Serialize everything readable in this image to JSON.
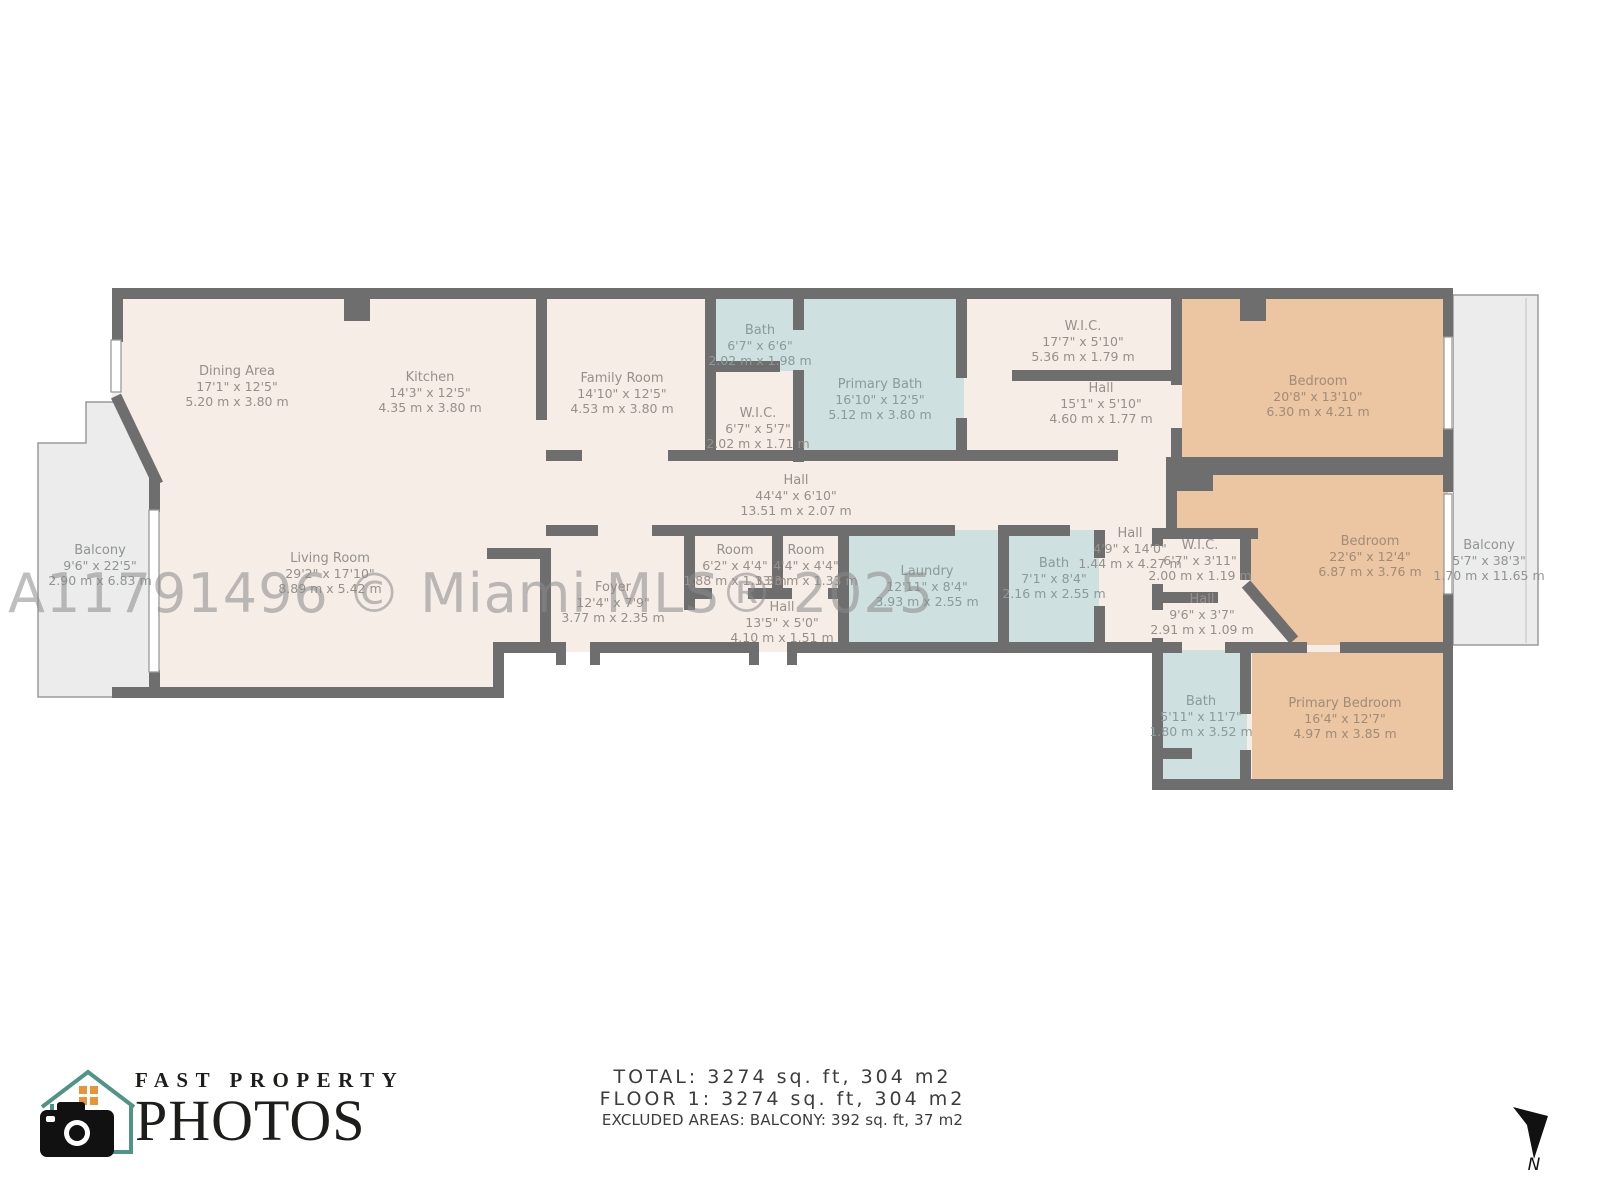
{
  "watermark": "A11791496 © Miami MLS® 2025",
  "footer": {
    "line1": "TOTAL: 3274 sq. ft, 304 m2",
    "line2": "FLOOR 1: 3274 sq. ft, 304 m2",
    "line3": "EXCLUDED AREAS: BALCONY: 392 sq. ft, 37 m2"
  },
  "logo": {
    "top": "FAST PROPERTY",
    "bottom": "PHOTOS"
  },
  "compass": {
    "label": "N"
  },
  "colors": {
    "wall": "#6e6e6e",
    "floor": "#f6ede7",
    "wet": "#cfe0e0",
    "bedroom": "#ecc5a2",
    "balcony": "#ececec",
    "outline": "#9a9a9a",
    "labelFloor": "#96908a",
    "labelWet": "#8a9b9b",
    "labelBedroom": "#a18c77",
    "labelBalcony": "#8f9494",
    "watermarkColor": "#8a8a8a",
    "footerColor": "#3c3c3c",
    "ink": "#1d1d1b",
    "logoTeal": "#4f9486",
    "logoOrange": "#e8953a"
  },
  "rooms": [
    {
      "name": "Dining Area",
      "ft": "17'1\" x 12'5\"",
      "m": "5.20 m x 3.80 m",
      "type": "floor",
      "x": 237,
      "y": 364
    },
    {
      "name": "Kitchen",
      "ft": "14'3\" x 12'5\"",
      "m": "4.35 m x 3.80 m",
      "type": "floor",
      "x": 430,
      "y": 370
    },
    {
      "name": "Family Room",
      "ft": "14'10\" x 12'5\"",
      "m": "4.53 m x 3.80 m",
      "type": "floor",
      "x": 622,
      "y": 371
    },
    {
      "name": "Bath",
      "ft": "6'7\" x 6'6\"",
      "m": "2.02 m x 1.98 m",
      "type": "wet",
      "x": 760,
      "y": 323
    },
    {
      "name": "W.I.C.",
      "ft": "6'7\" x 5'7\"",
      "m": "2.02 m x 1.71 m",
      "type": "floor",
      "x": 758,
      "y": 406
    },
    {
      "name": "Primary Bath",
      "ft": "16'10\" x 12'5\"",
      "m": "5.12 m x 3.80 m",
      "type": "wet",
      "x": 880,
      "y": 377
    },
    {
      "name": "W.I.C.",
      "ft": "17'7\" x 5'10\"",
      "m": "5.36 m x 1.79 m",
      "type": "floor",
      "x": 1083,
      "y": 319
    },
    {
      "name": "Hall",
      "ft": "15'1\" x 5'10\"",
      "m": "4.60 m x 1.77 m",
      "type": "floor",
      "x": 1101,
      "y": 381
    },
    {
      "name": "Bedroom",
      "ft": "20'8\" x 13'10\"",
      "m": "6.30 m x 4.21 m",
      "type": "bedroom",
      "x": 1318,
      "y": 374
    },
    {
      "name": "Balcony",
      "ft": "9'6\" x 22'5\"",
      "m": "2.90 m x 6.83 m",
      "type": "balcony",
      "x": 100,
      "y": 543
    },
    {
      "name": "Living Room",
      "ft": "29'2\" x 17'10\"",
      "m": "8.89 m x 5.42 m",
      "type": "floor",
      "x": 330,
      "y": 551
    },
    {
      "name": "Hall",
      "ft": "44'4\" x 6'10\"",
      "m": "13.51 m x 2.07 m",
      "type": "floor",
      "x": 796,
      "y": 473
    },
    {
      "name": "Foyer",
      "ft": "12'4\" x 7'9\"",
      "m": "3.77 m x 2.35 m",
      "type": "floor",
      "x": 613,
      "y": 580
    },
    {
      "name": "Room",
      "ft": "6'2\" x 4'4\"",
      "m": "1.88 m x 1.33 m",
      "type": "floor",
      "x": 735,
      "y": 543
    },
    {
      "name": "Room",
      "ft": "4'4\" x 4'4\"",
      "m": "1.33 m x 1.33 m",
      "type": "floor",
      "x": 806,
      "y": 543
    },
    {
      "name": "Hall",
      "ft": "13'5\" x 5'0\"",
      "m": "4.10 m x 1.51 m",
      "type": "floor",
      "x": 782,
      "y": 600
    },
    {
      "name": "Laundry",
      "ft": "12'11\" x 8'4\"",
      "m": "3.93 m x 2.55 m",
      "type": "wet",
      "x": 927,
      "y": 564
    },
    {
      "name": "Bath",
      "ft": "7'1\" x 8'4\"",
      "m": "2.16 m x 2.55 m",
      "type": "wet",
      "x": 1054,
      "y": 556
    },
    {
      "name": "Hall",
      "ft": "4'9\" x 14'0\"",
      "m": "1.44 m x 4.27 m",
      "type": "floor",
      "x": 1130,
      "y": 526
    },
    {
      "name": "W.I.C.",
      "ft": "6'7\" x 3'11\"",
      "m": "2.00 m x 1.19 m",
      "type": "floor",
      "x": 1200,
      "y": 538
    },
    {
      "name": "Hall",
      "ft": "9'6\" x 3'7\"",
      "m": "2.91 m x 1.09 m",
      "type": "floor",
      "x": 1202,
      "y": 592
    },
    {
      "name": "Bedroom",
      "ft": "22'6\" x 12'4\"",
      "m": "6.87 m x 3.76 m",
      "type": "bedroom",
      "x": 1370,
      "y": 534
    },
    {
      "name": "Balcony",
      "ft": "5'7\" x 38'3\"",
      "m": "1.70 m x 11.65 m",
      "type": "balcony",
      "x": 1489,
      "y": 538
    },
    {
      "name": "Bath",
      "ft": "5'11\" x 11'7\"",
      "m": "1.80 m x 3.52 m",
      "type": "wet",
      "x": 1201,
      "y": 694
    },
    {
      "name": "Primary Bedroom",
      "ft": "16'4\" x 12'7\"",
      "m": "4.97 m x 3.85 m",
      "type": "bedroom",
      "x": 1345,
      "y": 696
    }
  ]
}
